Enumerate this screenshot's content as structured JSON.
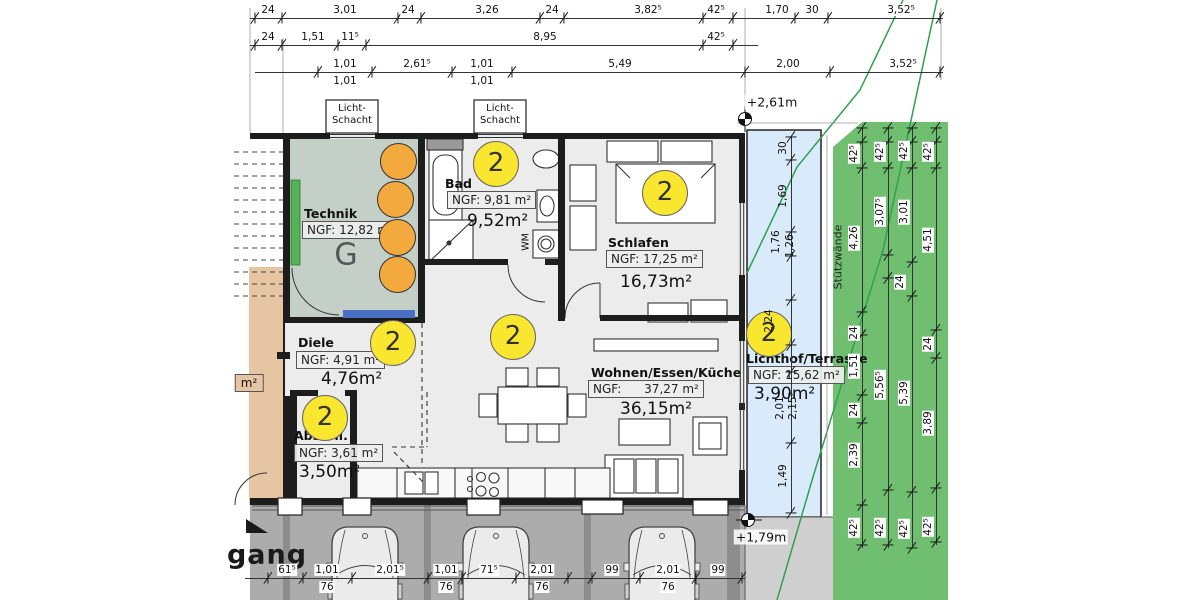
{
  "plan": {
    "rooms": [
      {
        "key": "technik",
        "name": "Technik",
        "ngf": "NGF: 12,82 m²",
        "area": "",
        "name_pos": [
          304,
          206
        ],
        "ngf_pos": [
          302,
          221
        ],
        "area_pos": [
          0,
          0
        ]
      },
      {
        "key": "bad",
        "name": "Bad",
        "ngf": "NGF: 9,81 m²",
        "area": "9,52m²",
        "name_pos": [
          445,
          176
        ],
        "ngf_pos": [
          447,
          191
        ],
        "area_pos": [
          467,
          211
        ]
      },
      {
        "key": "schlafen",
        "name": "Schlafen",
        "ngf": "NGF: 17,25 m²",
        "area": "16,73m²",
        "name_pos": [
          608,
          235
        ],
        "ngf_pos": [
          606,
          250
        ],
        "area_pos": [
          620,
          272
        ]
      },
      {
        "key": "diele",
        "name": "Diele",
        "ngf": "NGF: 4,91 m²",
        "area": "4,76m²",
        "name_pos": [
          298,
          335
        ],
        "ngf_pos": [
          296,
          351
        ],
        "area_pos": [
          321,
          369
        ]
      },
      {
        "key": "wohnen",
        "name": "Wohnen/Essen/Küche",
        "ngf": "NGF:      37,27 m²",
        "area": "36,15m²",
        "name_pos": [
          591,
          365
        ],
        "ngf_pos": [
          588,
          380
        ],
        "area_pos": [
          620,
          399
        ]
      },
      {
        "key": "abstell",
        "name": "Abstell.",
        "ngf": "NGF: 3,61 m²",
        "area": "3,50m²",
        "name_pos": [
          294,
          428
        ],
        "ngf_pos": [
          294,
          444
        ],
        "area_pos": [
          299,
          462
        ]
      },
      {
        "key": "lichthof",
        "name": "Lichthof/Terrasse",
        "ngf": "NGF: 15,62 m²",
        "area": "3,90m²",
        "name_pos": [
          746,
          351
        ],
        "ngf_pos": [
          748,
          366
        ],
        "area_pos": [
          754,
          384
        ]
      }
    ],
    "zone_circles": {
      "label": "2",
      "positions": [
        [
          495,
          163
        ],
        [
          664,
          192
        ],
        [
          392,
          342
        ],
        [
          512,
          336
        ],
        [
          324,
          417
        ],
        [
          768,
          333
        ]
      ]
    },
    "tanks": {
      "positions": [
        [
          397,
          160
        ],
        [
          394,
          198
        ],
        [
          396,
          236
        ],
        [
          396,
          273
        ]
      ]
    },
    "licht_schacht": {
      "line1": "Licht-",
      "line2": "Schacht",
      "boxes": [
        [
          326,
          100
        ],
        [
          474,
          100
        ]
      ]
    },
    "annotations": [
      {
        "id": "stuetzwaende",
        "text": "Stützwände",
        "x": 838,
        "y": 257,
        "rot": -90,
        "cls": "ann-vsmall"
      },
      {
        "id": "gang",
        "text": "gang",
        "x": 267,
        "y": 555,
        "rot": 0,
        "cls": "ann-gang"
      },
      {
        "id": "wm",
        "text": "WM",
        "x": 526,
        "y": 242,
        "rot": -90,
        "cls": "ann-wm"
      },
      {
        "id": "m2-fragment",
        "text": "m²",
        "x": 249,
        "y": 383,
        "rot": 0,
        "cls": "ann-frag"
      },
      {
        "id": "level-upper",
        "text": "+2,61m",
        "x": 772,
        "y": 102,
        "rot": 0,
        "cls": "ann-level"
      },
      {
        "id": "level-lower",
        "text": "+1,79m",
        "x": 761,
        "y": 537,
        "rot": 0,
        "cls": "ann-level"
      },
      {
        "id": "g-letter",
        "text": "G",
        "x": 346,
        "y": 255,
        "rot": 0,
        "cls": "ann-g"
      }
    ],
    "dim_rows": [
      {
        "id": "top-row-1",
        "y": 18,
        "x1": 250,
        "x2": 943,
        "ticks": [
          255,
          282,
          398,
          421,
          540,
          564,
          703,
          733,
          795,
          828,
          940
        ],
        "labels": [
          {
            "x": 268,
            "t": "24"
          },
          {
            "x": 345,
            "t": "3,01"
          },
          {
            "x": 408,
            "t": "24"
          },
          {
            "x": 487,
            "t": "3,26"
          },
          {
            "x": 552,
            "t": "24"
          },
          {
            "x": 648,
            "t": "3,82⁵"
          },
          {
            "x": 716,
            "t": "42⁵"
          },
          {
            "x": 777,
            "t": "1,70"
          },
          {
            "x": 812,
            "t": "30"
          },
          {
            "x": 901,
            "t": "3,52⁵"
          }
        ]
      },
      {
        "id": "top-row-2",
        "y": 45,
        "x1": 250,
        "x2": 758,
        "ticks": [
          255,
          282,
          338,
          366,
          703,
          733
        ],
        "labels": [
          {
            "x": 268,
            "t": "24"
          },
          {
            "x": 313,
            "t": "1,51"
          },
          {
            "x": 350,
            "t": "11⁵"
          },
          {
            "x": 545,
            "t": "8,95"
          },
          {
            "x": 716,
            "t": "42⁵"
          }
        ]
      },
      {
        "id": "top-row-3",
        "y": 72,
        "x1": 255,
        "x2": 943,
        "ticks": [
          318,
          372,
          452,
          512,
          745,
          830,
          940
        ],
        "labels": [
          {
            "x": 345,
            "t": "1,01",
            "t2": "1,01"
          },
          {
            "x": 417,
            "t": "2,61⁵"
          },
          {
            "x": 482,
            "t": "1,01",
            "t2": "1,01"
          },
          {
            "x": 620,
            "t": "5,49"
          },
          {
            "x": 788,
            "t": "2,00"
          },
          {
            "x": 903,
            "t": "3,52⁵"
          }
        ]
      },
      {
        "id": "bottom-row",
        "y": 578,
        "x1": 245,
        "x2": 745,
        "ticks": [
          268,
          303,
          352,
          428,
          462,
          516,
          568,
          592,
          640,
          696,
          742
        ],
        "labels": [
          {
            "x": 287,
            "t": "61⁵"
          },
          {
            "x": 327,
            "t": "1,01",
            "t2": "76"
          },
          {
            "x": 390,
            "t": "2,01⁵"
          },
          {
            "x": 446,
            "t": "1,01",
            "t2": "76"
          },
          {
            "x": 489,
            "t": "71⁵"
          },
          {
            "x": 542,
            "t": "2,01",
            "t2": "76"
          },
          {
            "x": 612,
            "t": "99"
          },
          {
            "x": 668,
            "t": "2,01",
            "t2": "76"
          },
          {
            "x": 718,
            "t": "99"
          }
        ]
      }
    ],
    "dim_chains": [
      {
        "id": "lichthof-chain",
        "x": 791,
        "y1": 137,
        "y2": 513,
        "boxed": false,
        "ticks": [
          137,
          160,
          232,
          256,
          300,
          345,
          372,
          443,
          513
        ],
        "labels": [
          {
            "y": 148,
            "t": "30"
          },
          {
            "y": 196,
            "t": "1,69"
          },
          {
            "y": 242,
            "t": "1,76",
            "dx": -7
          },
          {
            "y": 246,
            "t": "1,26",
            "dx": 7
          },
          {
            "y": 321,
            "t": "2,24",
            "dx": -14
          },
          {
            "y": 408,
            "t": "2,01",
            "dx": -3
          },
          {
            "y": 406,
            "t": "2,15⁵",
            "dx": 10
          },
          {
            "y": 476,
            "t": "1,49"
          }
        ]
      },
      {
        "id": "wall-chain-1",
        "x": 862,
        "y1": 128,
        "y2": 548,
        "boxed": true,
        "ticks": [
          128,
          142,
          168,
          312,
          335,
          395,
          423,
          505,
          545
        ],
        "labels": [
          {
            "y": 154,
            "t": "42⁵"
          },
          {
            "y": 238,
            "t": "4,26"
          },
          {
            "y": 333,
            "t": "24"
          },
          {
            "y": 366,
            "t": "1,51"
          },
          {
            "y": 410,
            "t": "24"
          },
          {
            "y": 455,
            "t": "2,39"
          },
          {
            "y": 528,
            "t": "42⁵"
          }
        ]
      },
      {
        "id": "wall-chain-2",
        "x": 888,
        "y1": 128,
        "y2": 548,
        "boxed": true,
        "ticks": [
          128,
          142,
          168,
          255,
          278,
          490,
          545
        ],
        "labels": [
          {
            "y": 152,
            "t": "42⁵"
          },
          {
            "y": 212,
            "t": "3,07⁵"
          },
          {
            "y": 385,
            "t": "5,56⁵"
          },
          {
            "y": 528,
            "t": "42⁵"
          }
        ]
      },
      {
        "id": "wall-chain-3",
        "x": 912,
        "y1": 128,
        "y2": 548,
        "boxed": true,
        "ticks": [
          128,
          142,
          168,
          262,
          296,
          492,
          548
        ],
        "labels": [
          {
            "y": 151,
            "t": "42⁵"
          },
          {
            "y": 212,
            "t": "3,01"
          },
          {
            "y": 282,
            "t": "24",
            "dx": -4
          },
          {
            "y": 393,
            "t": "5,39"
          },
          {
            "y": 529,
            "t": "42⁵"
          }
        ]
      },
      {
        "id": "wall-chain-4",
        "x": 936,
        "y1": 128,
        "y2": 545,
        "boxed": true,
        "ticks": [
          128,
          142,
          168,
          330,
          358,
          488,
          542
        ],
        "labels": [
          {
            "y": 152,
            "t": "42⁵"
          },
          {
            "y": 240,
            "t": "4,51"
          },
          {
            "y": 344,
            "t": "24"
          },
          {
            "y": 423,
            "t": "3,89"
          },
          {
            "y": 527,
            "t": "42⁵"
          }
        ]
      }
    ]
  }
}
